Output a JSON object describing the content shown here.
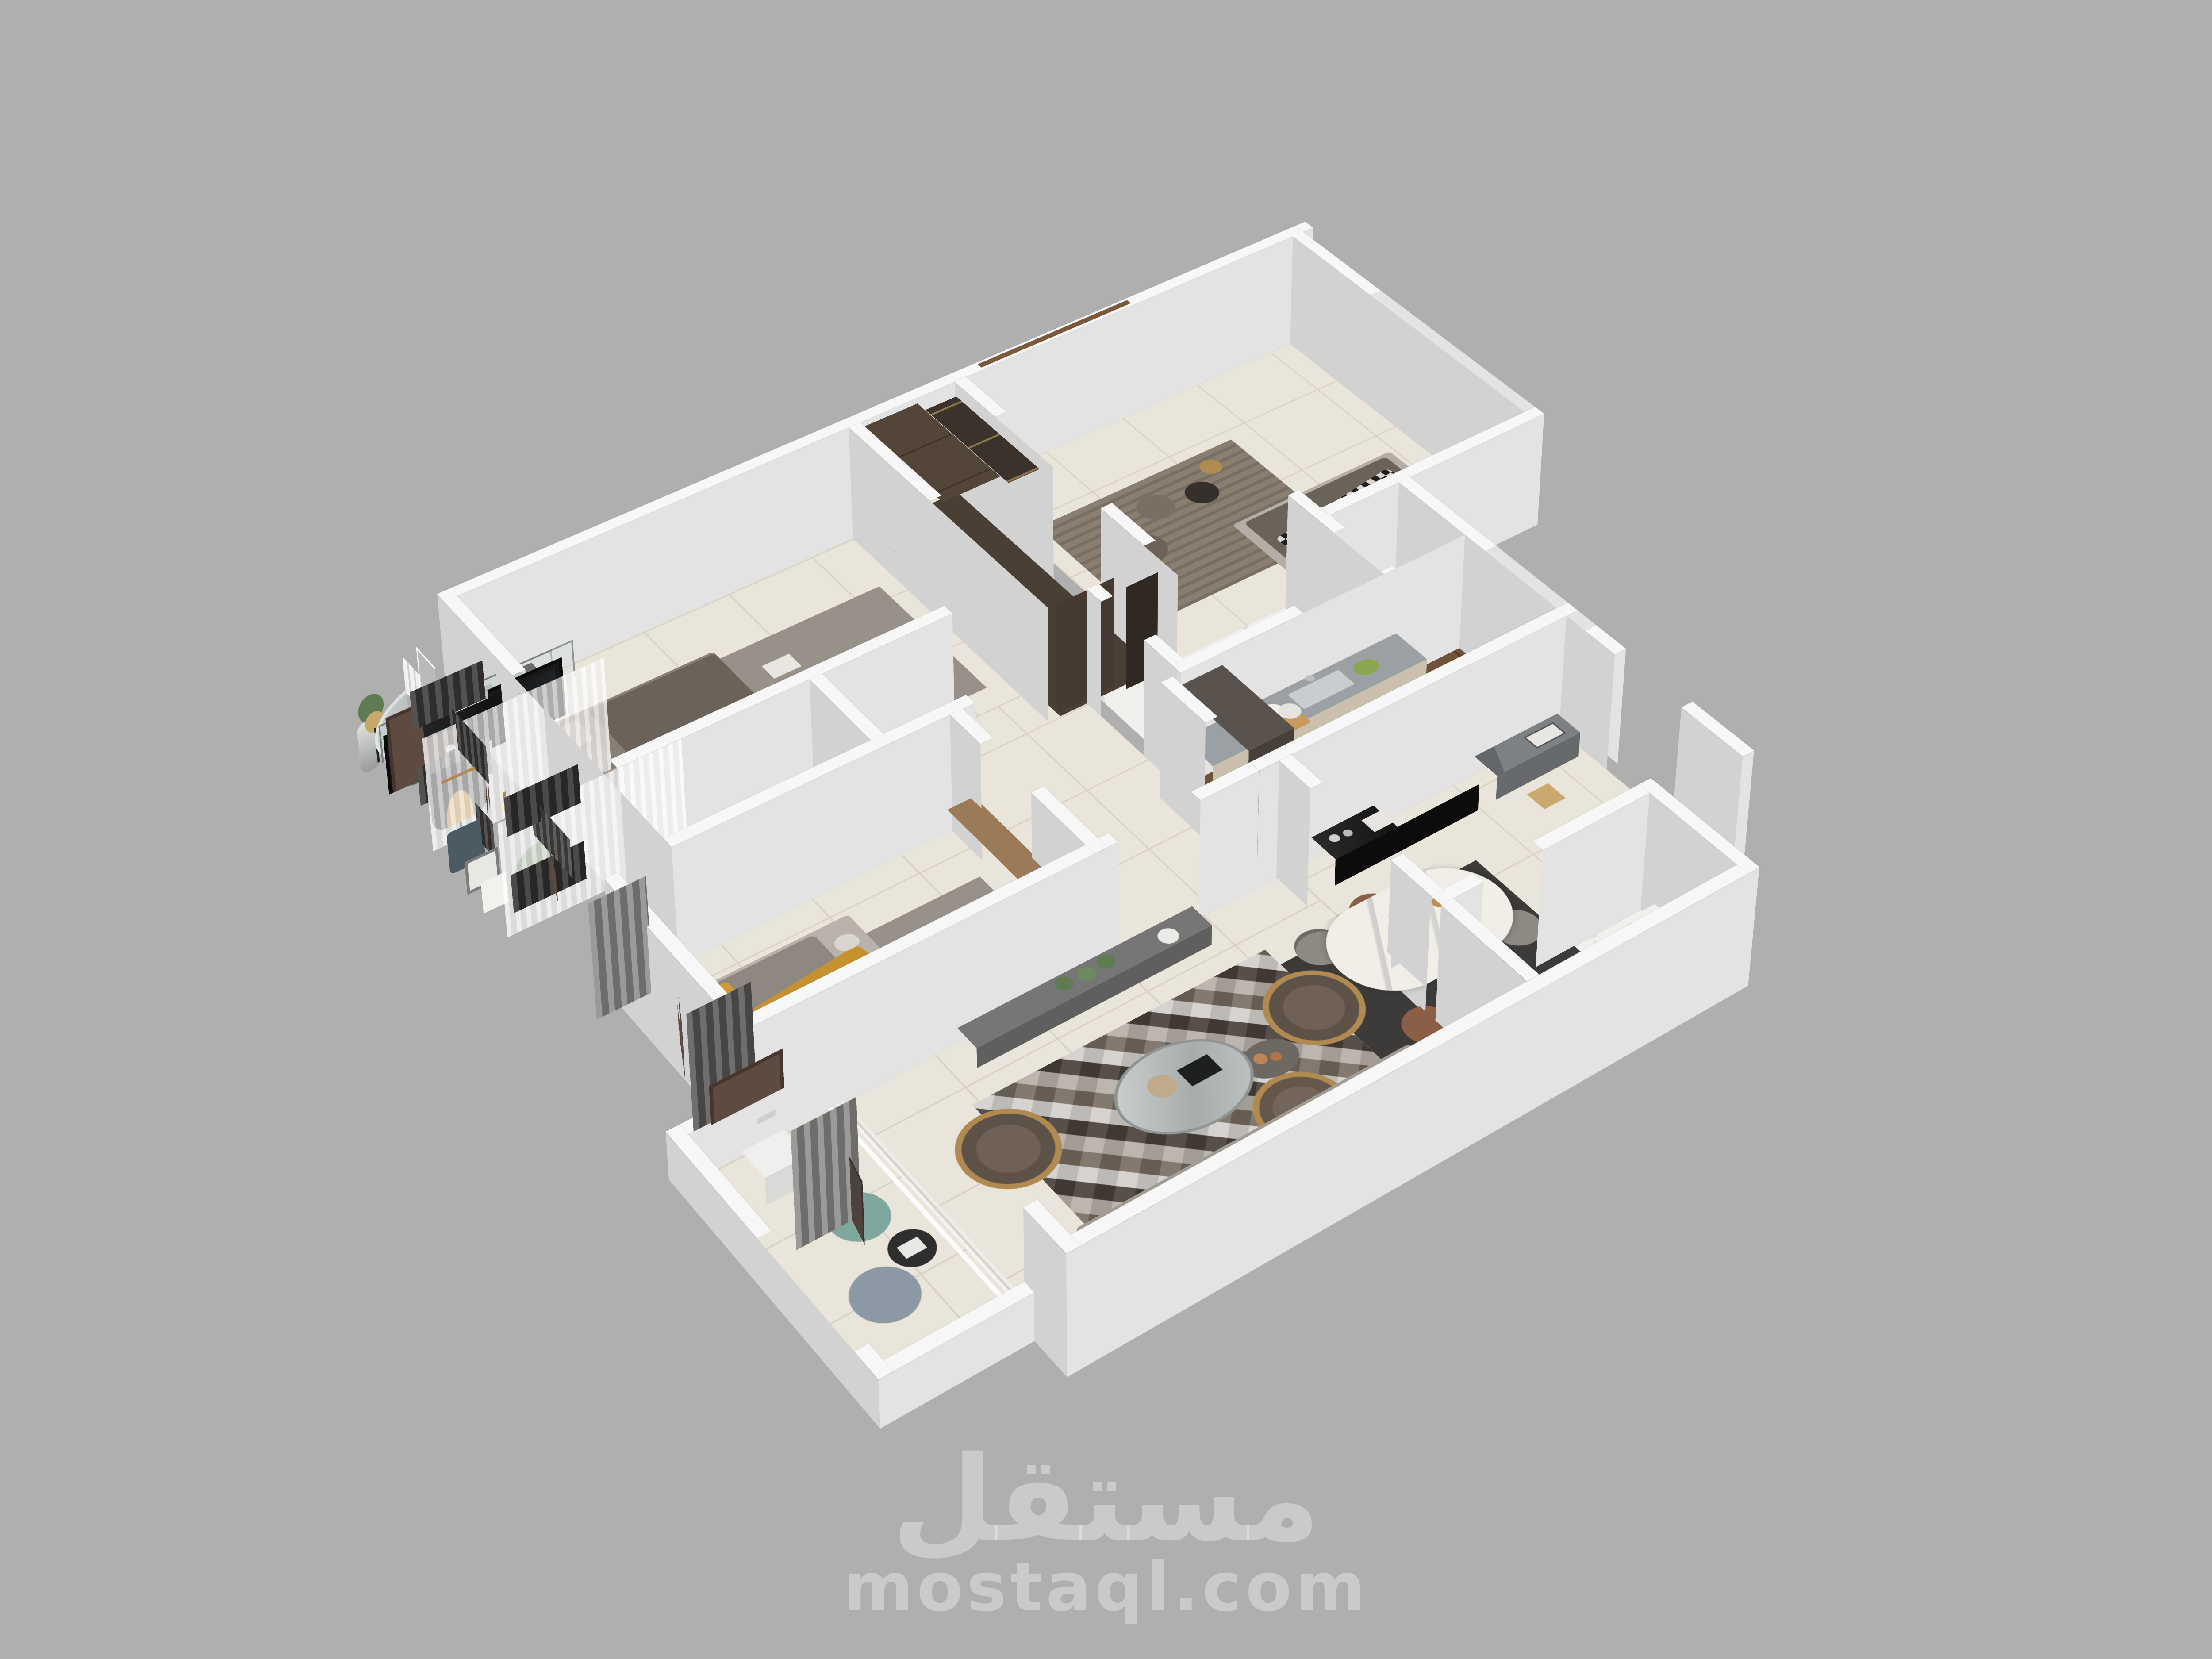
{
  "watermark": {
    "logo": "مستقل",
    "site": "mostaql.com"
  },
  "palette": {
    "bg": "#afafaf",
    "wallTop": "#f7f7f7",
    "wallSide": "#e3e3e3",
    "wallSideW": "#d2d2d2",
    "floorTile": "#eae5da",
    "grout": "#d9d3c5",
    "marble": "#f2f0ed",
    "wood": "#6f5238",
    "doorBrown": "#5d4a40",
    "wardrobe": "#453931",
    "wardrobeTop": "#544539",
    "glassWardrobe": "#2f2823",
    "curtainDark": "#3c3a39",
    "curtainGray": "#8e8c8a",
    "sheer": "rgba(255,255,255,0.55)",
    "bedGray": "#878077",
    "bedDark": "#6b6259",
    "headboard": "#56473b",
    "rugGray": "#97918a",
    "rugBrown": "#897e70",
    "yellowThrow": "#c6922f",
    "sofaGray": "#a39c93",
    "chairBrown": "#5e5147",
    "gold": "#b08a50",
    "tvBlack": "#181818",
    "consoleBlack": "#141414",
    "consoleGray": "#7d8183",
    "diningTable": "#f1eee8",
    "chairGray": "#8e8983",
    "diningRug": "#3d3b39",
    "poufTeal": "#7ea79e",
    "poufBlue": "#8c98a3",
    "plantGreen": "#5f7b52",
    "counterGray": "#9aa0a4",
    "cabinetBeige": "#cbbfad",
    "watermark": "rgba(255,255,255,0.34)"
  },
  "scene": {
    "type": "3d-apartment-floor-plan-render",
    "rooms": [
      {
        "name": "Master bedroom",
        "items": [
          "double bed",
          "leather headboard",
          "pillows",
          "nightstand with lamp",
          "gray rug",
          "gray and sheer curtains",
          "magazines"
        ]
      },
      {
        "name": "En-suite bathroom",
        "items": [
          "marble walls",
          "glass shower",
          "wood stool"
        ]
      },
      {
        "name": "Dressing wardrobes",
        "items": [
          "tall dark wood wardrobe",
          "sliding glass wardrobe with bronze frames"
        ]
      },
      {
        "name": "Bedroom 2",
        "items": [
          "bed with houndstooth throw",
          "black swag curtains",
          "wood window frame",
          "round side tables",
          "poufs",
          "brown rug"
        ]
      },
      {
        "name": "Kids bedroom",
        "items": [
          "single bed",
          "yellow throw",
          "white slat headboard wall",
          "gray rug",
          "dark curtains",
          "wood cabinet"
        ]
      },
      {
        "name": "Hallway",
        "items": [
          "brown interior doors"
        ]
      },
      {
        "name": "Bathroom",
        "items": [
          "marble floor",
          "glass shower partition",
          "dark shower tray"
        ]
      },
      {
        "name": "Kitchen",
        "items": [
          "L-shaped beige cabinets",
          "gray countertop",
          "sink with faucet",
          "fruits",
          "plates",
          "tall dark unit",
          "wood floor"
        ]
      },
      {
        "name": "Living room",
        "items": [
          "gray sofa",
          "three brown armchairs with gold ribbed bases",
          "diamond pattern rug",
          "round mirror coffee table",
          "marble side table",
          "gray TV console",
          "wall TV",
          "statue",
          "plants",
          "gold floor lamp"
        ]
      },
      {
        "name": "Dining area",
        "items": [
          "oval marble dining table",
          "six chairs",
          "dark rug",
          "table plant"
        ]
      },
      {
        "name": "Entrance hall",
        "items": [
          "black gloss console",
          "oval mirror",
          "black floor lamp with gold interior",
          "gray console table",
          "table lamp",
          "picture frames",
          "paper bag",
          "entry door"
        ]
      },
      {
        "name": "Guest WC",
        "items": [
          "marble walls",
          "wash basin",
          "wood framed window",
          "brown door"
        ]
      },
      {
        "name": "Balcony",
        "items": [
          "potted plants",
          "teal pouf",
          "blue pouf",
          "small black table",
          "white railing"
        ]
      }
    ]
  }
}
